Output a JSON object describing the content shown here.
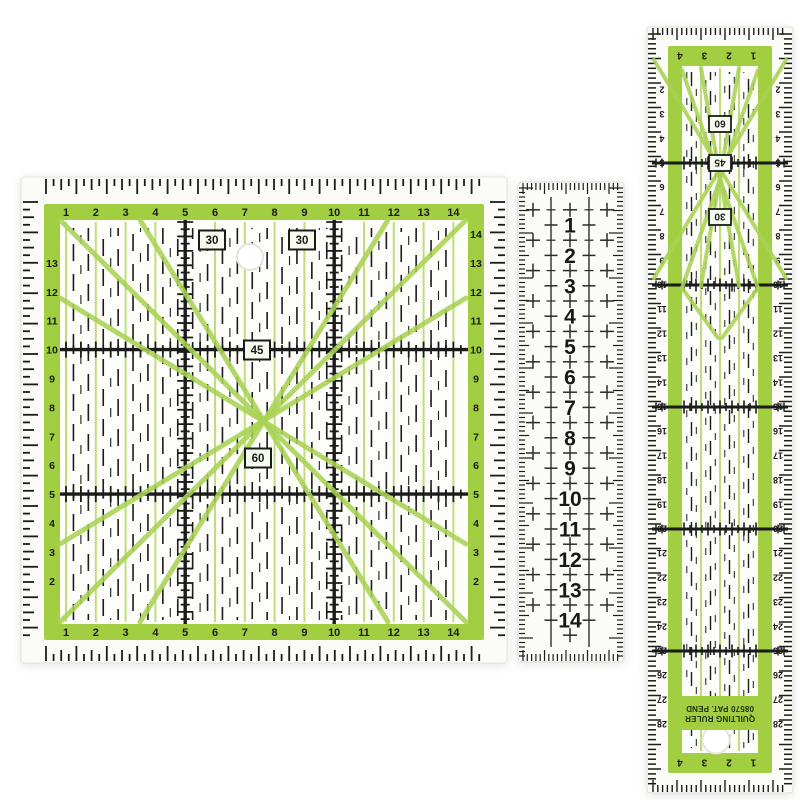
{
  "colors": {
    "background": "#ffffff",
    "frame_green": "#a2ce41",
    "line_green": "#c0dd7e",
    "diag_green": "#a9d254",
    "ink": "#1b1b1b",
    "plate": "#fbfbf8",
    "plate_inner": "#fdfefa",
    "box_fill": "#f7faee"
  },
  "square_ruler": {
    "top_scale": [
      "1",
      "2",
      "3",
      "4",
      "5",
      "6",
      "7",
      "8",
      "9",
      "10",
      "11",
      "12",
      "13",
      "14"
    ],
    "bottom_scale": [
      "1",
      "2",
      "3",
      "4",
      "5",
      "6",
      "7",
      "8",
      "9",
      "10",
      "11",
      "12",
      "13",
      "14"
    ],
    "left_scale": [
      "13",
      "12",
      "11",
      "10",
      "9",
      "8",
      "7",
      "6",
      "5",
      "4",
      "3",
      "2"
    ],
    "right_scale": [
      "14",
      "13",
      "12",
      "11",
      "10",
      "9",
      "8",
      "7",
      "6",
      "5",
      "4",
      "3",
      "2"
    ],
    "angle_boxes": [
      "30",
      "30",
      "45",
      "60"
    ],
    "major_units": [
      5,
      10
    ]
  },
  "middle_ruler": {
    "numbers": [
      "1",
      "2",
      "3",
      "4",
      "5",
      "6",
      "7",
      "8",
      "9",
      "10",
      "11",
      "12",
      "13",
      "14"
    ]
  },
  "long_ruler": {
    "top_scale": [
      "4",
      "3",
      "2",
      "1"
    ],
    "bottom_scale": [
      "4",
      "3",
      "2",
      "1"
    ],
    "left_scale": [
      "2",
      "3",
      "4",
      "5",
      "6",
      "7",
      "8",
      "9",
      "10",
      "11",
      "12",
      "13",
      "14",
      "15",
      "16",
      "17",
      "18",
      "19",
      "20",
      "21",
      "22",
      "23",
      "24",
      "25",
      "26",
      "27",
      "28"
    ],
    "right_scale": [
      "2",
      "3",
      "4",
      "5",
      "6",
      "7",
      "8",
      "9",
      "10",
      "11",
      "12",
      "13",
      "14",
      "15",
      "16",
      "17",
      "18",
      "19",
      "20",
      "21",
      "22",
      "23",
      "24",
      "25",
      "26",
      "27",
      "28"
    ],
    "angle_boxes": [
      "60",
      "45",
      "30"
    ],
    "major_units": [
      5,
      10,
      15,
      20,
      25
    ],
    "label_line1": "QUILTING RULER",
    "label_line2": "08570  PAT. PEND"
  }
}
